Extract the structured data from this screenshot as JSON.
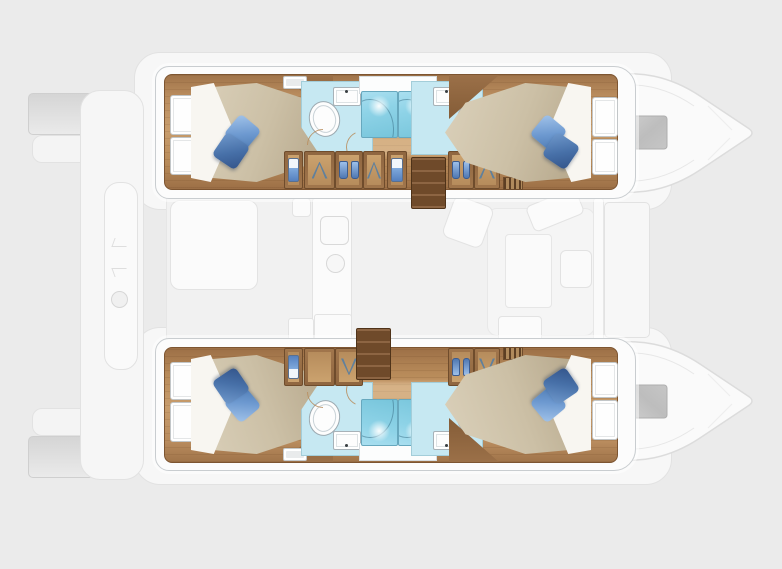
{
  "meta": {
    "description": "Top-down interior floor plan of a four-cabin sailing catamaran; hull interiors rendered in colour (wood floors, beds, bathrooms), saloon and decks shown as light ghosted outlines",
    "canvas": {
      "width": 782,
      "height": 569
    }
  },
  "colors": {
    "background": "#ebebeb",
    "ghost_fill": "#f4f4f4",
    "ghost_stroke": "#e2e2e2",
    "hull_white": "#fcfcfc",
    "hull_stroke": "#c9cdd0",
    "wood": "#b98c5e",
    "wood_dark": "#7d5531",
    "wood_light": "#c89d6d",
    "stair_wood": "#6f4a2a",
    "mattress": "#ccc0a6",
    "sheet": "#f8f6f1",
    "pillow_light": "#6d99d0",
    "pillow_dark": "#4770a8",
    "bath_floor": "#c6e8f2",
    "shower_fill": "#8ed3e7",
    "shower_stroke": "#67a8be",
    "fixture_stroke": "#9daab1",
    "closet_blue": "#7fa9dc",
    "hatch_gray": "#c2c2c2"
  },
  "hulls": [
    {
      "id": "port-hull",
      "position": "top",
      "rooms": [
        {
          "type": "double-cabin",
          "location": "aft",
          "items": [
            "island-bed",
            "2-pillows",
            "sheet",
            "hull-window-panels",
            "deck-hatch"
          ]
        },
        {
          "type": "bathroom",
          "location": "aft",
          "items": [
            "toilet",
            "washbasin",
            "shower-cabin"
          ]
        },
        {
          "type": "bathroom",
          "location": "forward",
          "items": [
            "toilet",
            "washbasin",
            "shower-cabin"
          ]
        },
        {
          "type": "double-cabin",
          "location": "forward",
          "items": [
            "island-bed",
            "2-pillows",
            "sheet",
            "hull-window-panels"
          ]
        }
      ],
      "corridor": [
        "wardrobe-units-with-hangers",
        "companionway-stairs",
        "vent-grate"
      ]
    },
    {
      "id": "starboard-hull",
      "position": "bottom",
      "rooms": [
        {
          "type": "double-cabin",
          "location": "aft",
          "items": [
            "island-bed",
            "2-pillows",
            "sheet",
            "hull-window-panels",
            "deck-hatch"
          ]
        },
        {
          "type": "bathroom",
          "location": "aft",
          "items": [
            "toilet",
            "washbasin",
            "shower-cabin"
          ]
        },
        {
          "type": "bathroom",
          "location": "forward",
          "items": [
            "toilet",
            "washbasin",
            "shower-cabin"
          ]
        },
        {
          "type": "double-cabin",
          "location": "forward",
          "items": [
            "island-bed",
            "2-pillows",
            "sheet",
            "hull-window-panels"
          ]
        }
      ],
      "corridor": [
        "wardrobe-units-with-hangers",
        "companionway-stairs",
        "vent-grate"
      ]
    }
  ],
  "saloon": {
    "style": "ghosted",
    "items": [
      "galley-counter",
      "galley-column",
      "stove",
      "round-sink",
      "lower-cabinets",
      "dinette-table",
      "l-sofa",
      "chaise",
      "seat-back",
      "chair",
      "front-bulkhead",
      "foredeck"
    ]
  },
  "exterior": {
    "style": "ghosted",
    "stern": [
      "port-transom-steps",
      "starboard-transom-steps",
      "aft-platform-band",
      "tender-capsule",
      "winch"
    ],
    "bows": [
      "port-bow-with-deck-hatch",
      "starboard-bow-with-deck-hatch"
    ]
  }
}
